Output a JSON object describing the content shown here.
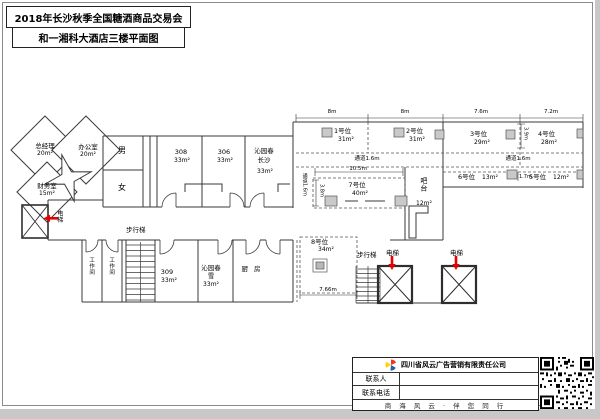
{
  "title": {
    "line1": "2018年长沙秋季全国糖酒商品交易会",
    "line2": "和一湘科大酒店三楼平面图"
  },
  "plan": {
    "gm_name": "总经理",
    "gm_area": "20m²",
    "office_name": "办公室",
    "office_area": "20m²",
    "fin_name": "财务室",
    "fin_area": "15m²",
    "male": "男",
    "female": "女",
    "elevator": "电梯",
    "workroom": "工作间",
    "stairs": "步行梯",
    "r308": "308",
    "r306": "306",
    "r309": "309",
    "area33": "33m²",
    "qyc": "沁园春",
    "changsha": "长沙",
    "xue": "雪",
    "kitchen": "厨 房",
    "b1": "1号位",
    "b1_area": "31m²",
    "b2": "2号位",
    "b2_area": "31m²",
    "b3": "3号位",
    "b3_area": "29m²",
    "b4": "4号位",
    "b4_area": "28m²",
    "b5": "5号位",
    "b5_area": "12m²",
    "b6": "6号位",
    "b6_area": "13m²",
    "b7": "7号位",
    "b7_area": "40m²",
    "b8": "8号位",
    "b8_area": "34m²",
    "bar": "吧台",
    "bar_area": "12m²",
    "aisle": "通道1.6m",
    "dim_8m": "8m",
    "dim_7_6": "7.6m",
    "dim_7_2": "7.2m",
    "dim_10_5": "10.5m",
    "dim_7_66": "7.66m",
    "dim_1_7": "1.7m",
    "dim_3_9": "3.9m",
    "dim_3_8": "3.8m"
  },
  "footer": {
    "company": "四川省风云广告营销有限责任公司",
    "contact_label": "联系人",
    "contact_value": "",
    "phone_label": "联系电话",
    "phone_value": "",
    "slogan": "商 海 风 云 · 伴 您 同 行"
  },
  "colors": {
    "accent_red": "#e60000",
    "line": "#3a3a3a"
  }
}
